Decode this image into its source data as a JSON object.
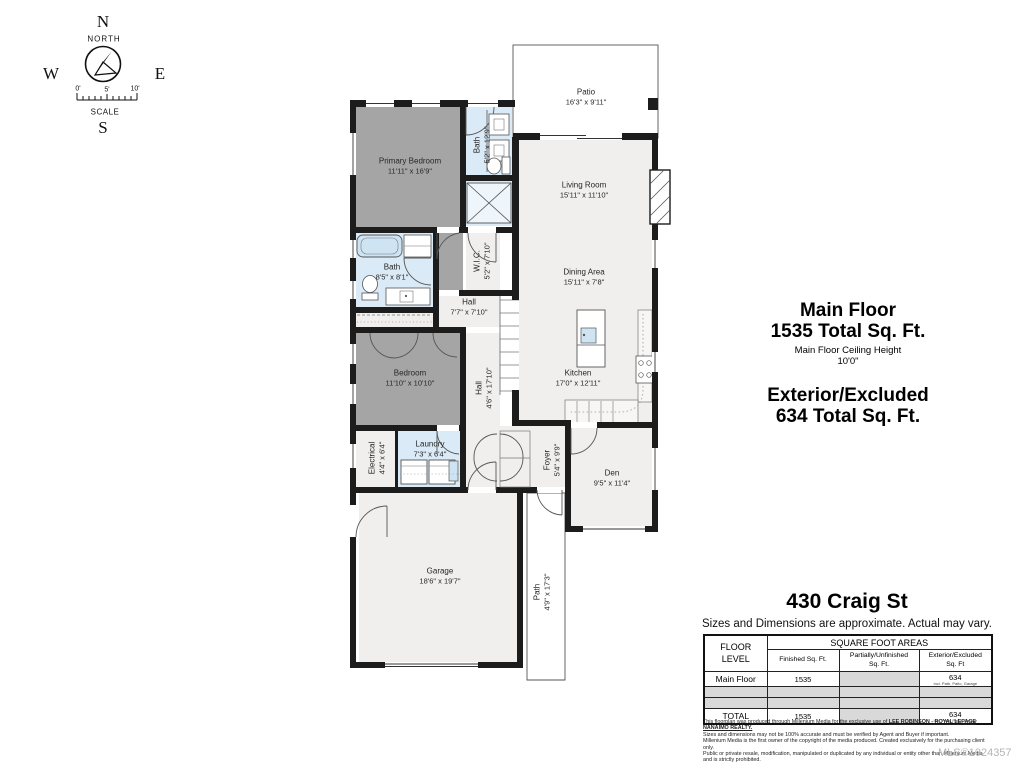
{
  "compass": {
    "n": "N",
    "north_label": "NORTH",
    "w": "W",
    "e": "E",
    "s": "S",
    "scale_label": "SCALE",
    "ticks": {
      "t0": "0'",
      "t5": "5'",
      "t10": "10'"
    }
  },
  "rooms": {
    "primary_bedroom": {
      "name": "Primary Bedroom",
      "dims": "11'11\" x 16'9\""
    },
    "bath_top": {
      "name": "Bath",
      "dims": "5'2\" x 12'9\""
    },
    "patio": {
      "name": "Patio",
      "dims": "16'3\" x 9'11\""
    },
    "living_room": {
      "name": "Living Room",
      "dims": "15'11\" x 11'10\""
    },
    "bath_main": {
      "name": "Bath",
      "dims": "8'5\" x 8'1\""
    },
    "wic": {
      "name": "W.I.C.",
      "dims": "5'2\" x 7'10\""
    },
    "hall_upper": {
      "name": "Hall",
      "dims": "7'7\" x 7'10\""
    },
    "dining_area": {
      "name": "Dining Area",
      "dims": "15'11\" x 7'8\""
    },
    "bedroom": {
      "name": "Bedroom",
      "dims": "11'10\" x 10'10\""
    },
    "hall_lower": {
      "name": "Hall",
      "dims": "4'6\" x 17'10\""
    },
    "kitchen": {
      "name": "Kitchen",
      "dims": "17'0\" x 12'11\""
    },
    "electrical": {
      "name": "Electrical",
      "dims": "4'4\" x 6'4\""
    },
    "laundry": {
      "name": "Laundry",
      "dims": "7'3\" x 6'4\""
    },
    "foyer": {
      "name": "Foyer",
      "dims": "5'4\" x 9'9\""
    },
    "den": {
      "name": "Den",
      "dims": "9'5\" x 11'4\""
    },
    "garage": {
      "name": "Garage",
      "dims": "18'6\" x 19'7\""
    },
    "path": {
      "name": "Path",
      "dims": "4'9\" x 17'3\""
    }
  },
  "summary": {
    "main_floor_title": "Main Floor",
    "main_floor_sqft": "1535 Total Sq. Ft.",
    "ceiling_height_label": "Main Floor Ceiling Height",
    "ceiling_height": "10'0\"",
    "exterior_title": "Exterior/Excluded",
    "exterior_sqft": "634 Total Sq. Ft."
  },
  "address": "430 Craig St",
  "approx_note": "Sizes and Dimensions are approximate. Actual may vary.",
  "table": {
    "floor_level_header": "FLOOR\nLEVEL",
    "group_header": "SQUARE FOOT AREAS",
    "col_finished": "Finished Sq. Ft.",
    "col_partial": "Partially/Unfinished\nSq. Ft.",
    "col_exterior": "Exterior/Excluded\nSq. Ft",
    "rows": {
      "main_floor": {
        "label": "Main Floor",
        "finished": "1535",
        "partial": "",
        "exterior": "634",
        "exterior_note": "Incl. Path, Patio, Garage"
      },
      "total": {
        "label": "TOTAL",
        "finished": "1535",
        "partial": "",
        "exterior": "634",
        "exterior_note": "Incl. Path, Patio, Garage"
      }
    }
  },
  "fine_print": {
    "l1a": "This floorplan was produced through Millenium Media for the exclusive use of ",
    "l1b": "LEE ROBINSON - ROYAL LEPAGE NANAIMO REALTY.",
    "l2": "Sizes and dimensions may not be 100% accurate and must be verified by Agent and Buyer if important.",
    "l3": "Millenium Media is the first owner of the copyright of the media produced. Created exclusively for the purchasing client only.",
    "l4": "Public or private resale, modification, manipulated or duplicated by any individual or entity other than Millenium Media and is strictly prohibited."
  },
  "mls": "MLS®1024357",
  "colors": {
    "wall": "#1c1c1c",
    "room_grey": "#a5a5a5",
    "room_light": "#f0efed",
    "room_blue": "#daeaf6",
    "table_grey": "#d9d9d9",
    "mls_text": "#b4b4b4"
  }
}
